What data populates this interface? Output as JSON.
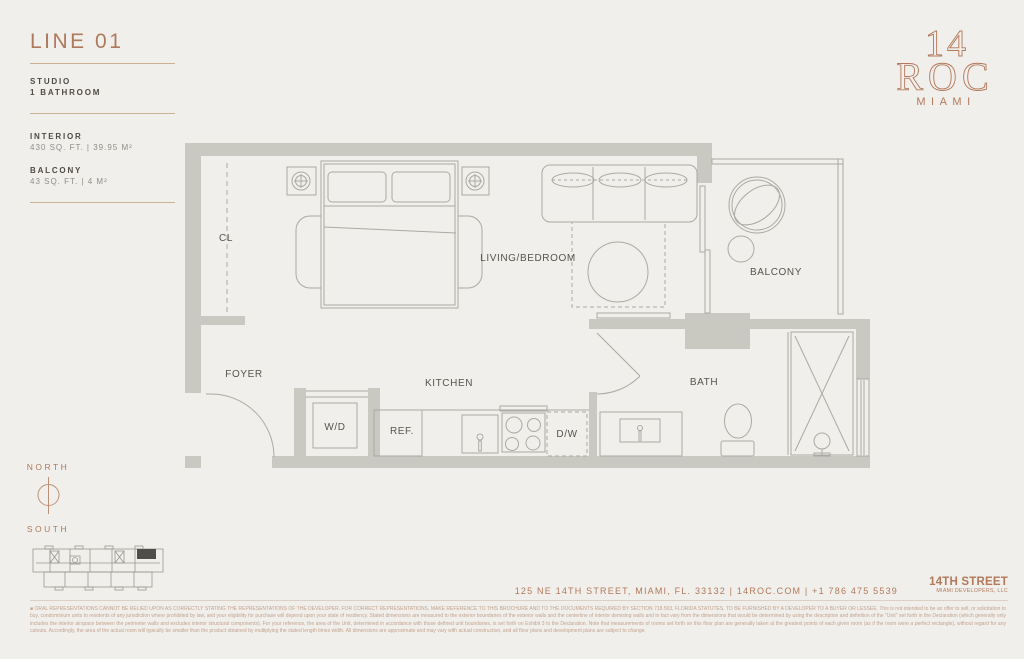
{
  "colors": {
    "background": "#f1efeb",
    "accent_terracotta": "#b1785a",
    "wall_gray": "#c9c8c1",
    "line_gray": "#aaa9a2",
    "label_gray": "#56544e",
    "sidebar_heading": "#4f4b45",
    "sidebar_value": "#8e8d88",
    "divider_tan": "#ccb096",
    "keyplan_unit_fill": "#4f4e49",
    "disclaimer_text": "#c3a28d"
  },
  "sidebar": {
    "title": "LINE 01",
    "unit_type": "STUDIO",
    "bathrooms": "1 BATHROOM",
    "interior_label": "INTERIOR",
    "interior_value": "430 SQ. FT. | 39.95 M²",
    "balcony_label": "BALCONY",
    "balcony_value": "43 SQ. FT. | 4 M²"
  },
  "logo": {
    "number": "14",
    "name": "ROC",
    "city": "MIAMI"
  },
  "plan": {
    "labels": {
      "closet": "CL",
      "living_bedroom": "LIVING/BEDROOM",
      "balcony": "BALCONY",
      "foyer": "FOYER",
      "kitchen": "KITCHEN",
      "bath": "BATH",
      "washer_dryer": "W/D",
      "refrigerator": "REF.",
      "dishwasher": "D/W"
    }
  },
  "compass": {
    "north": "NORTH",
    "south": "SOUTH"
  },
  "footer": {
    "address": "125 NE 14TH STREET, MIAMI, FL. 33132  |  14ROC.COM  |  +1 786 475 5539",
    "developer": "14TH STREET",
    "developer_subtitle": "MIAMI DEVELOPERS, LLC"
  },
  "disclaimer": "■ ORAL REPRESENTATIONS CANNOT BE RELIED UPON AS CORRECTLY STATING THE REPRESENTATIONS OF THE DEVELOPER. FOR CORRECT REPRESENTATIONS, MAKE REFERENCE TO THIS BROCHURE AND TO THE DOCUMENTS REQUIRED BY SECTION 718.503, FLORIDA STATUTES, TO BE FURNISHED BY A DEVELOPER TO A BUYER OR LESSEE. This is not intended to be an offer to sell, or solicitation to buy, condominium units to residents of any jurisdiction where prohibited by law, and your eligibility for purchase will depend upon your state of residency. Stated dimensions are measured to the exterior boundaries of the exterior walls and the centerline of interior demising walls and in fact vary from the dimensions that would be determined by using the description and definition of the \"Unit\" set forth in the Declaration (which generally only includes the interior airspace between the perimeter walls and excludes interior structural components). For your reference, the area of the Unit, determined in accordance with those defined unit boundaries, is set forth on Exhibit 3 to the Declaration. Note that measurements of rooms set forth on this floor plan are generally taken at the greatest points of each given room (as if the room were a perfect rectangle), without regard for any cutouts. Accordingly, the area of the actual room will typically be smaller than the product obtained by multiplying the stated length times width. All dimensions are approximate and may vary with actual construction, and all floor plans and development plans are subject to change."
}
